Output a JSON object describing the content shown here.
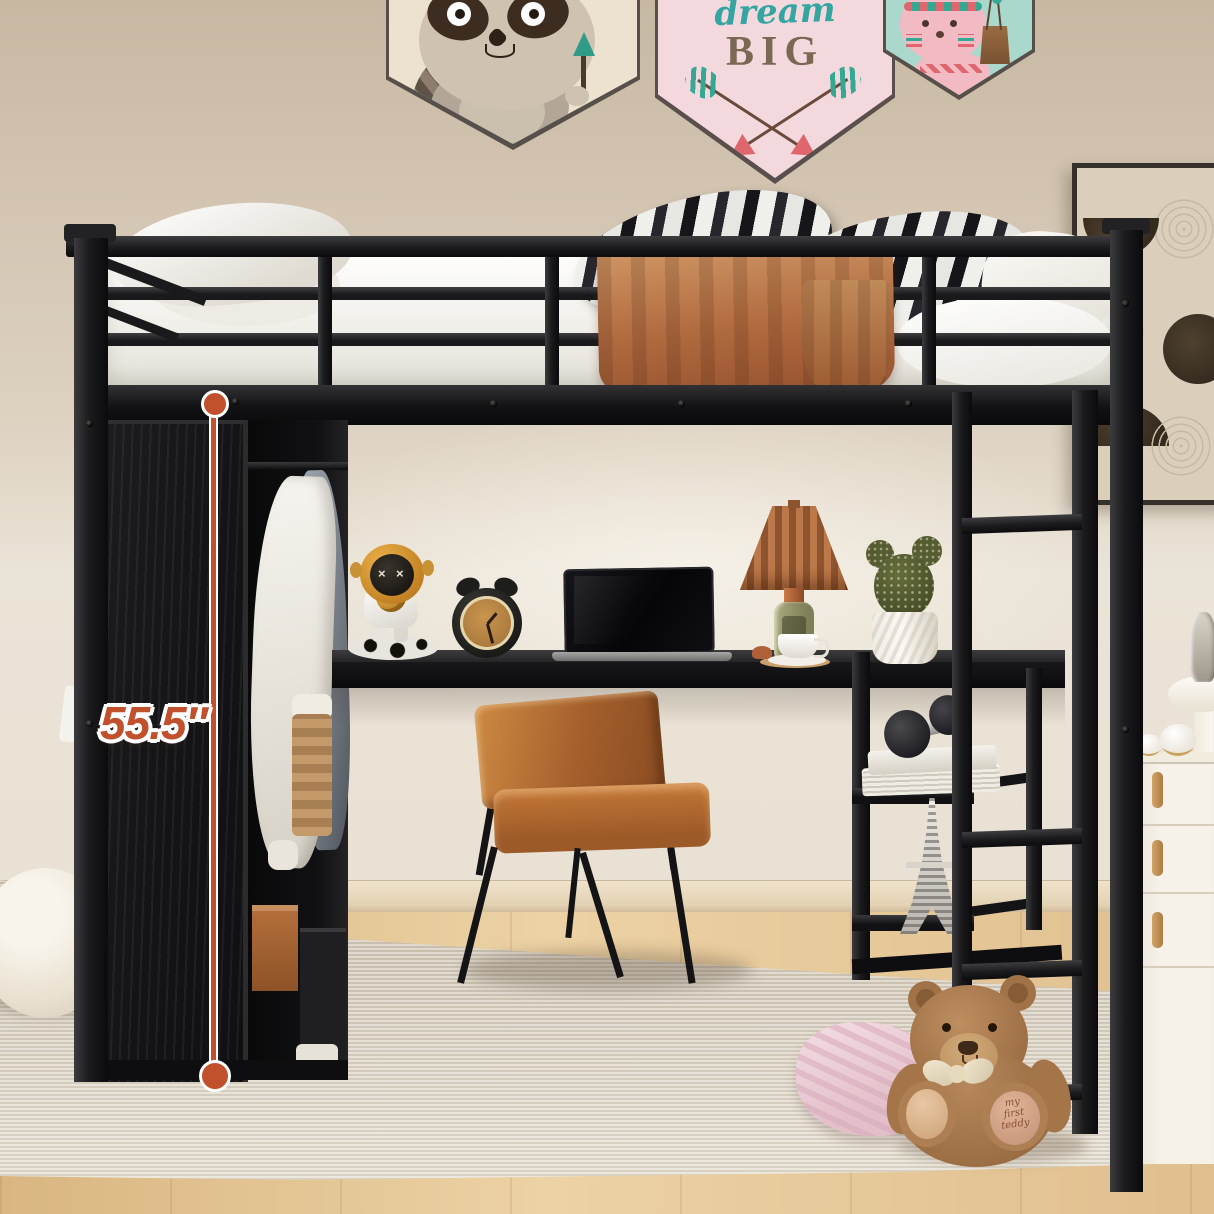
{
  "annotation": {
    "label": "55.5″",
    "accent_color": "#c1502d"
  },
  "banners": {
    "raccoon": {
      "bg": "#ece2cf"
    },
    "dream_big": {
      "word1": "dream",
      "word2": "BIG",
      "bg": "#f3d9de",
      "word1_color": "#35a5a1",
      "word2_color": "#7b6853"
    },
    "bunny": {
      "bg": "#abd8cd"
    }
  },
  "teddy": {
    "foot_lines": [
      "my",
      "first",
      "teddy"
    ],
    "text_color": "#8a4f38"
  },
  "palette": {
    "metal_frame": "#1a1a1c",
    "wall": "#d6c8b5",
    "wood_floor": "#e2c094",
    "rug": "#d8cfc0",
    "chair_leather": "#b4703a",
    "lamp_shade": "#b06a42",
    "towel": "#b5724a",
    "blanket_pink": "#ecd2da",
    "teddy_fur": "#a87a4f"
  }
}
